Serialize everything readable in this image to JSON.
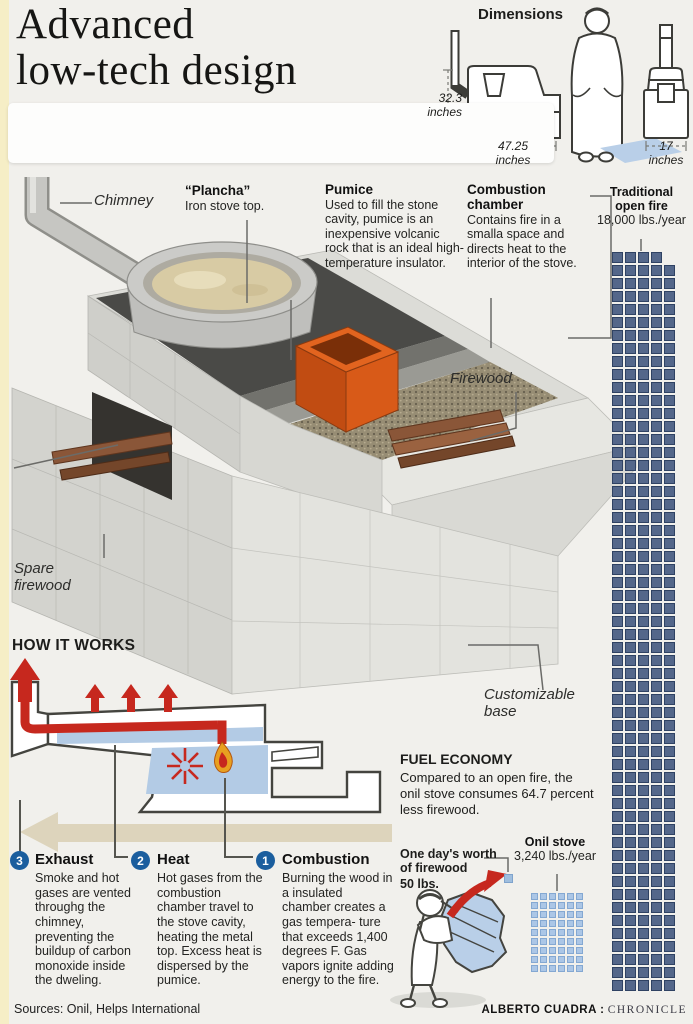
{
  "page": {
    "bg": "#f1f0ec",
    "accent_red": "#c6281e",
    "strip_yellow": "#f6eec6"
  },
  "title": {
    "text": "Advanced\nlow-tech design"
  },
  "dimensions": {
    "heading": "Dimensions",
    "height": "32.3\ninches",
    "width": "47.25\ninches",
    "front_width": "17\ninches"
  },
  "callouts": {
    "chimney": "Chimney",
    "plancha_title": "“Plancha”",
    "plancha_body": "Iron stove top.",
    "pumice_title": "Pumice",
    "pumice_body": "Used to fill the stone cavity, pumice is an inexpensive volcanic rock that is an ideal high-temperature insulator.",
    "combustion_title": "Combustion\nchamber",
    "combustion_body": "Contains fire in a smalla space and directs heat to the interior of the stove.",
    "firewood": "Firewood",
    "spare_firewood": "Spare\nfirewood",
    "customizable_base": "Customizable\nbase"
  },
  "comparison": {
    "open_fire": {
      "title": "Traditional\nopen fire",
      "value": "18,000 lbs./year",
      "grid": {
        "cols": 5,
        "rows": 57,
        "first_row_cols": 4,
        "square_color": "#54678a",
        "border_color": "#2f4263"
      }
    },
    "onil": {
      "title": "Onil stove",
      "value": "3,240 lbs./year",
      "grid": {
        "cols": 6,
        "rows": 9,
        "square_color": "#abc6e6",
        "border_color": "#84a8d2"
      }
    },
    "one_day": {
      "title": "One day's worth\nof firewood",
      "value": "50 lbs."
    }
  },
  "how_it_works": {
    "heading": "HOW IT WORKS",
    "steps": [
      {
        "num": "3",
        "title": "Exhaust",
        "body": "Smoke and hot gases are vented throughg the chimney, preventing the buildup of carbon monoxide inside the dweling."
      },
      {
        "num": "2",
        "title": "Heat",
        "body": "Hot gases from the combustion chamber travel to the stove cavity, heating the metal top. Excess heat is dispersed by the pumice."
      },
      {
        "num": "1",
        "title": "Combustion",
        "body": "Burning the wood in a insulated chamber creates a gas tempera- ture that exceeds 1,400 degrees F. Gas vapors ignite adding energy to the fire."
      }
    ]
  },
  "fuel_economy": {
    "heading": "FUEL ECONOMY",
    "body": "Compared to an open fire, the onil stove consumes 64.7 percent less firewood."
  },
  "footer": {
    "sources": "Sources: Onil, Helps International",
    "credit_name": "ALBERTO CUADRA :",
    "credit_org": "CHRONICLE"
  }
}
